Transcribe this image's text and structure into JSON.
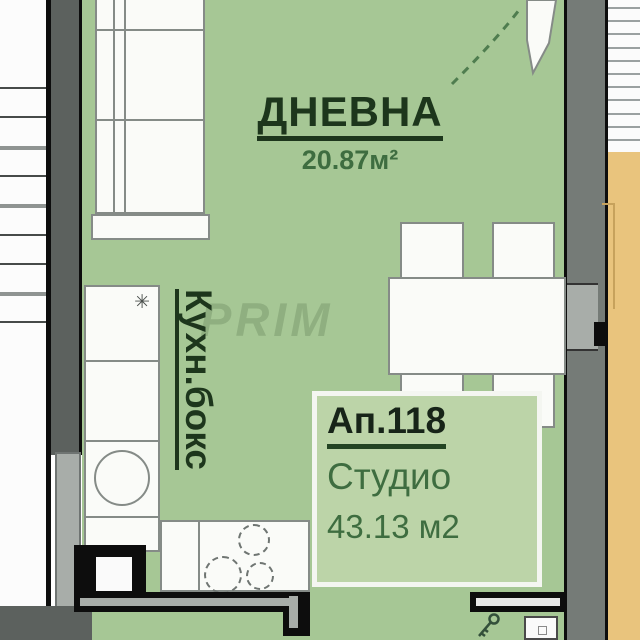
{
  "plan": {
    "rooms": {
      "living": {
        "name": "ДНЕВНА",
        "area": "20.87м²"
      },
      "kitchen": {
        "name": "Кухн.бокс"
      },
      "apartment": {
        "number": "Ап.118",
        "type": "Студио",
        "area": "43.13 м2"
      }
    },
    "watermark": "PRIM",
    "icons": {
      "stove": "✳",
      "key": "key-icon",
      "sink": "sink-circle",
      "burners": "cooktop-burners"
    }
  },
  "colors": {
    "room_green": "#a6c795",
    "label_green": "#bcd4a8",
    "beige": "#e9c47d",
    "wall_gray": "#5c615e",
    "wall_gray_light": "#757b77",
    "door_gray": "#a8ada9",
    "text_dark": "#1d361c",
    "text_green": "#3e6d40"
  }
}
